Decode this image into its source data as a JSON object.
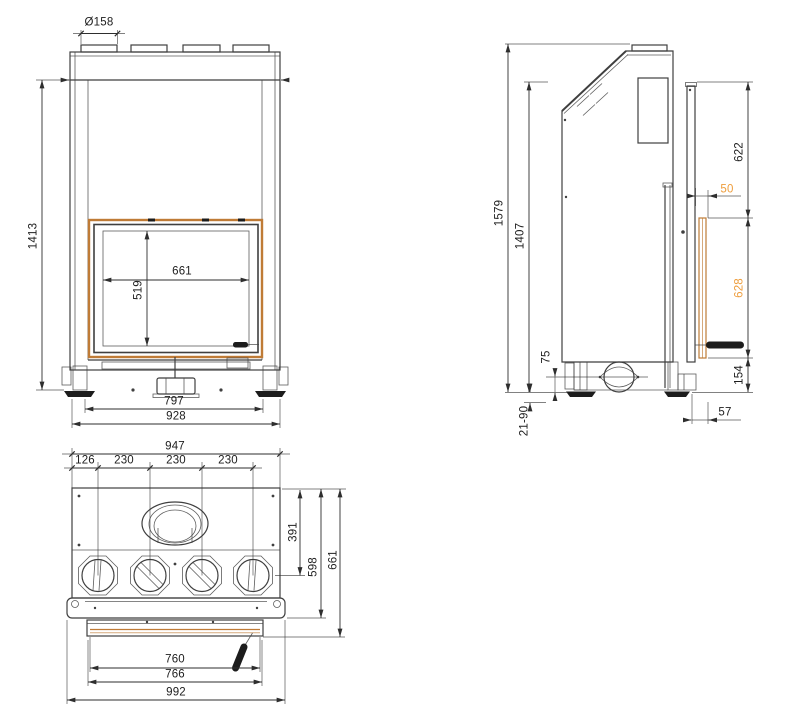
{
  "title": "Fireplace insert technical drawing — front, side and top orthographic views",
  "colors": {
    "background": "#ffffff",
    "line": "#3f3f3f",
    "dim": "#2e2e2e",
    "frame": "#bf7b36",
    "accent_text": "#ee9d3c",
    "handle": "#1c1c1c"
  },
  "views": {
    "front": {
      "label": "front view",
      "dims": {
        "flue_diameter": "Ø158",
        "overall_height": "1413",
        "glass_width": "661",
        "glass_height": "519",
        "feet_span": "797",
        "overall_width": "928"
      }
    },
    "side": {
      "label": "side view",
      "dims": {
        "total_height": "1579",
        "frame_height": "1407",
        "upper_section": "622",
        "frame_gap": "50",
        "door_glass_height": "628",
        "intake_axis_height": "75",
        "lower_section": "154",
        "foot_adjust_range": "21-90",
        "front_depth": "57"
      }
    },
    "top": {
      "label": "top view",
      "dims": {
        "body_width": "947",
        "edge_to_first_outlet": "126",
        "outlet_spacing_1": "230",
        "outlet_spacing_2": "230",
        "outlet_spacing_3": "230",
        "flue_axis_depth": "391",
        "body_depth": "598",
        "frame_depth": "661",
        "glass_opening_width": "760",
        "door_width": "766",
        "frame_width": "992"
      }
    }
  }
}
